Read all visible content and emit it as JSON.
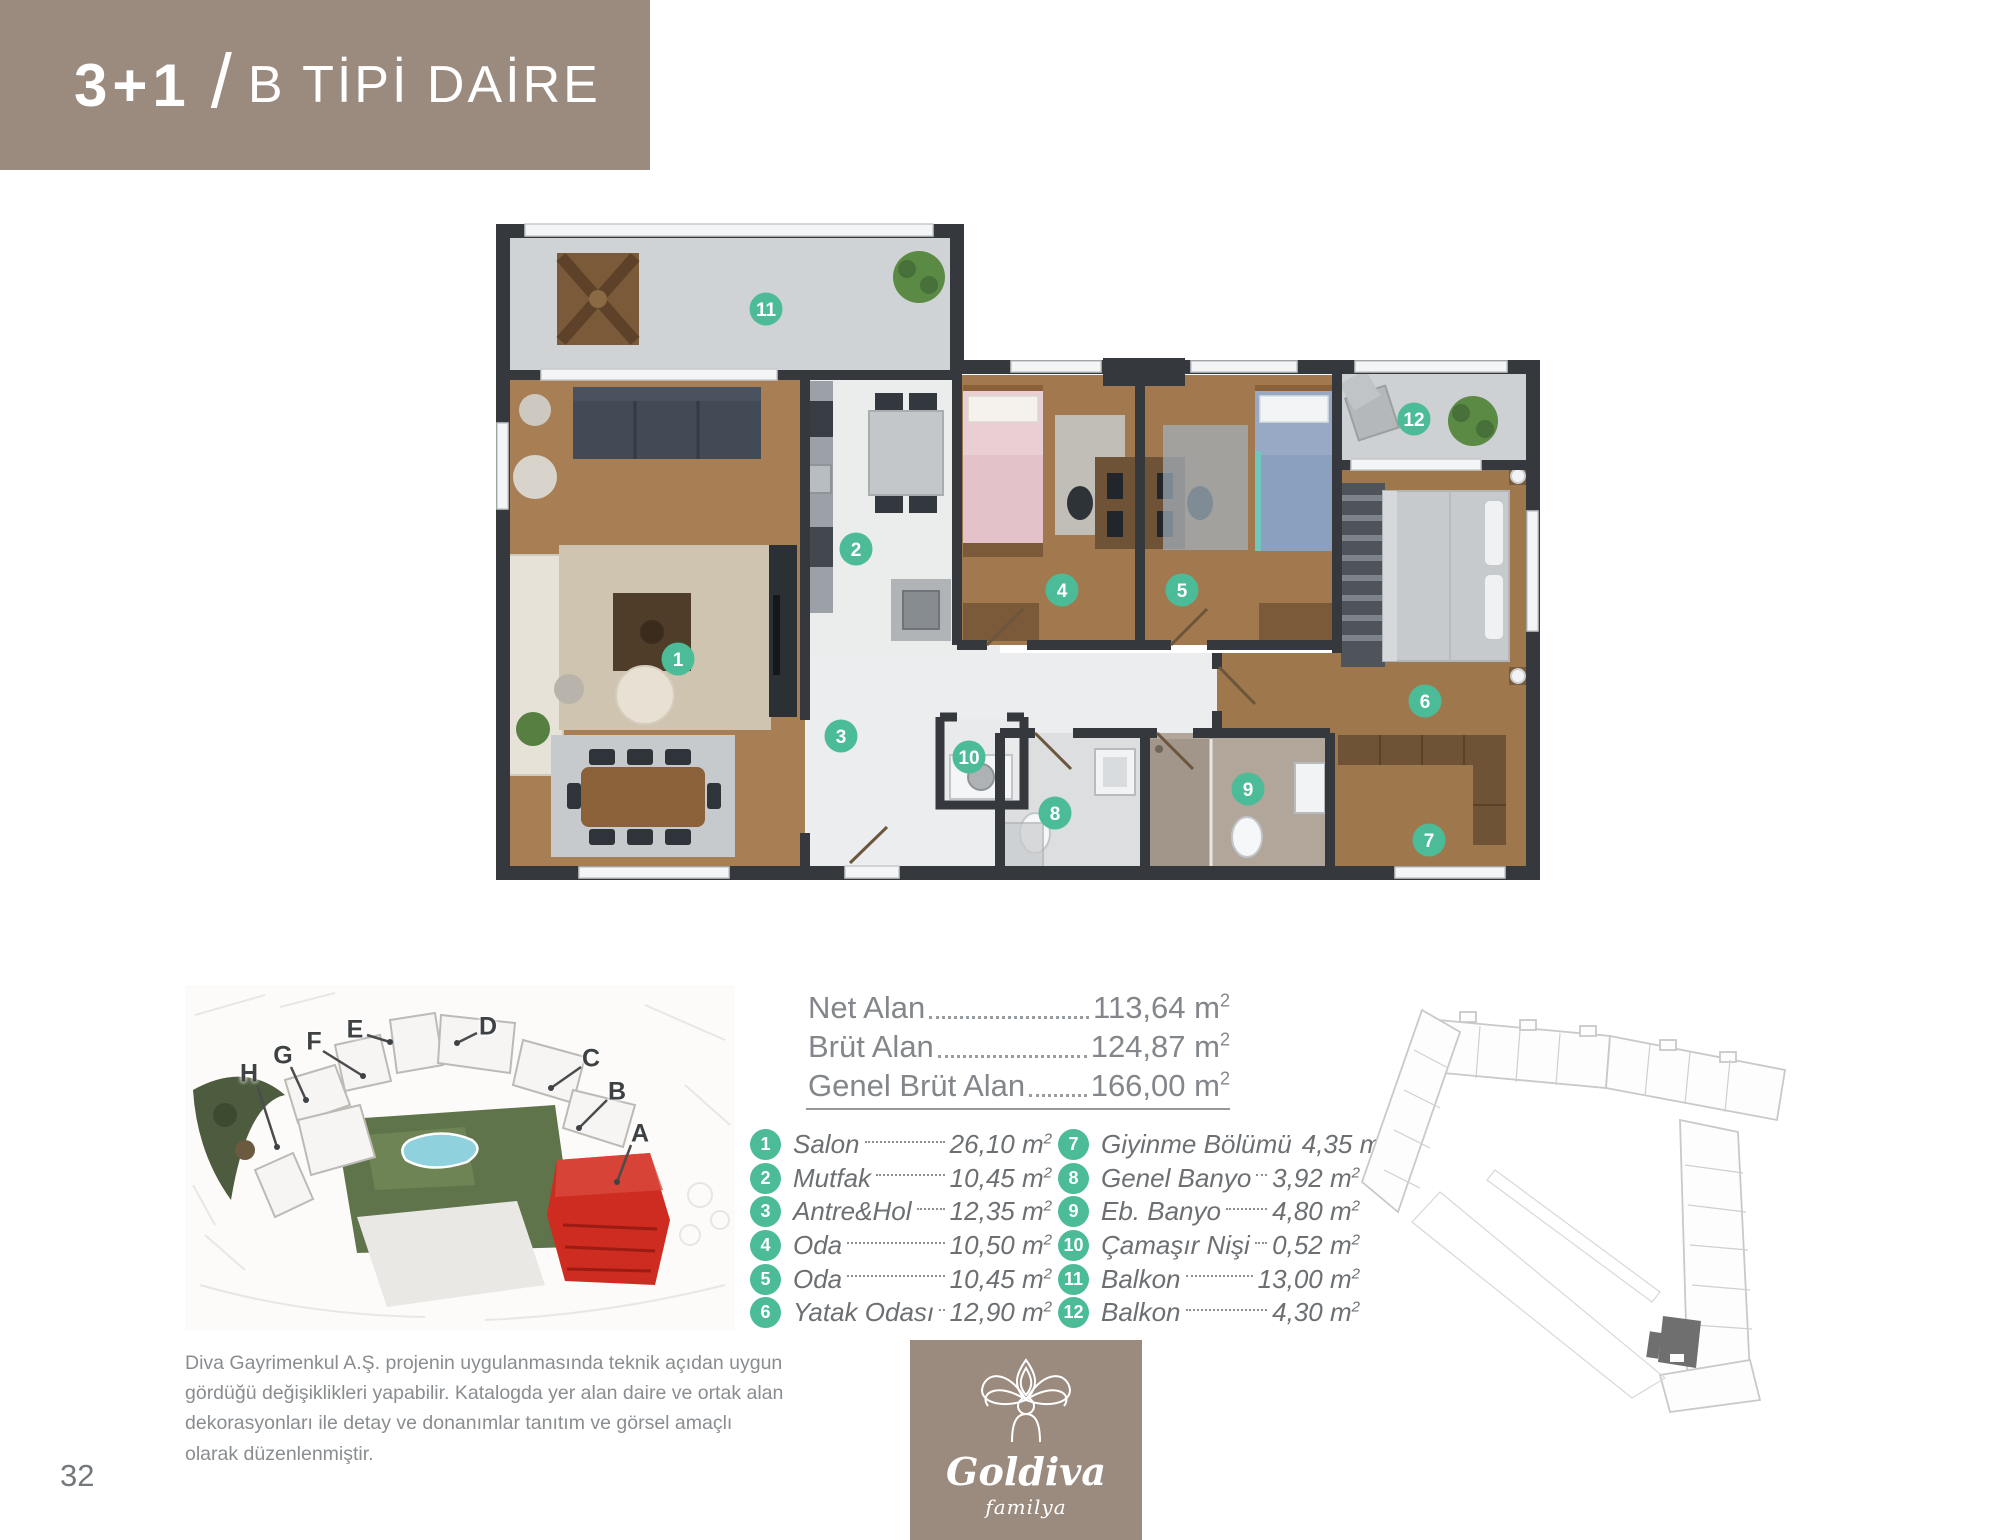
{
  "header": {
    "unit_type": "3+1",
    "separator": "/",
    "title": "B TİPİ DAİRE"
  },
  "areas": {
    "rows": [
      {
        "label": "Net Alan",
        "value": "113,64"
      },
      {
        "label": "Brüt Alan",
        "value": "124,87"
      },
      {
        "label": "Genel Brüt Alan",
        "value": "166,00"
      }
    ],
    "unit": "m",
    "unit_sup": "2"
  },
  "rooms": [
    {
      "no": "1",
      "name": "Salon",
      "area": "26,10"
    },
    {
      "no": "2",
      "name": "Mutfak",
      "area": "10,45"
    },
    {
      "no": "3",
      "name": "Antre&Hol",
      "area": "12,35"
    },
    {
      "no": "4",
      "name": "Oda",
      "area": "10,50"
    },
    {
      "no": "5",
      "name": "Oda",
      "area": "10,45"
    },
    {
      "no": "6",
      "name": "Yatak Odası",
      "area": "12,90"
    },
    {
      "no": "7",
      "name": "Giyinme Bölümü",
      "area": "4,35"
    },
    {
      "no": "8",
      "name": "Genel Banyo",
      "area": "3,92"
    },
    {
      "no": "9",
      "name": "Eb. Banyo",
      "area": "4,80"
    },
    {
      "no": "10",
      "name": "Çamaşır Nişi",
      "area": "0,52"
    },
    {
      "no": "11",
      "name": "Balkon",
      "area": "13,00"
    },
    {
      "no": "12",
      "name": "Balkon",
      "area": "4,30"
    }
  ],
  "site_overview": {
    "labels": [
      "A",
      "B",
      "C",
      "D",
      "E",
      "F",
      "G",
      "H"
    ]
  },
  "disclaimer": {
    "text": "Diva Gayrimenkul A.Ş. projenin uygulanmasında teknik açıdan uygun gördüğü değişiklikleri yapabilir. Katalogda yer alan daire ve ortak alan dekorasyonları ile detay ve donanımlar tanıtım ve görsel amaçlı olarak düzenlenmiştir."
  },
  "footer": {
    "page_number": "32"
  },
  "logo": {
    "name": "Goldiva",
    "subtitle": "familya"
  },
  "colors": {
    "header_brown": "#9b8b7f",
    "accent_teal": "#4cbb97",
    "site_highlight_red": "#ce2b21",
    "outline_highlight_gray": "#6f6f6f"
  }
}
